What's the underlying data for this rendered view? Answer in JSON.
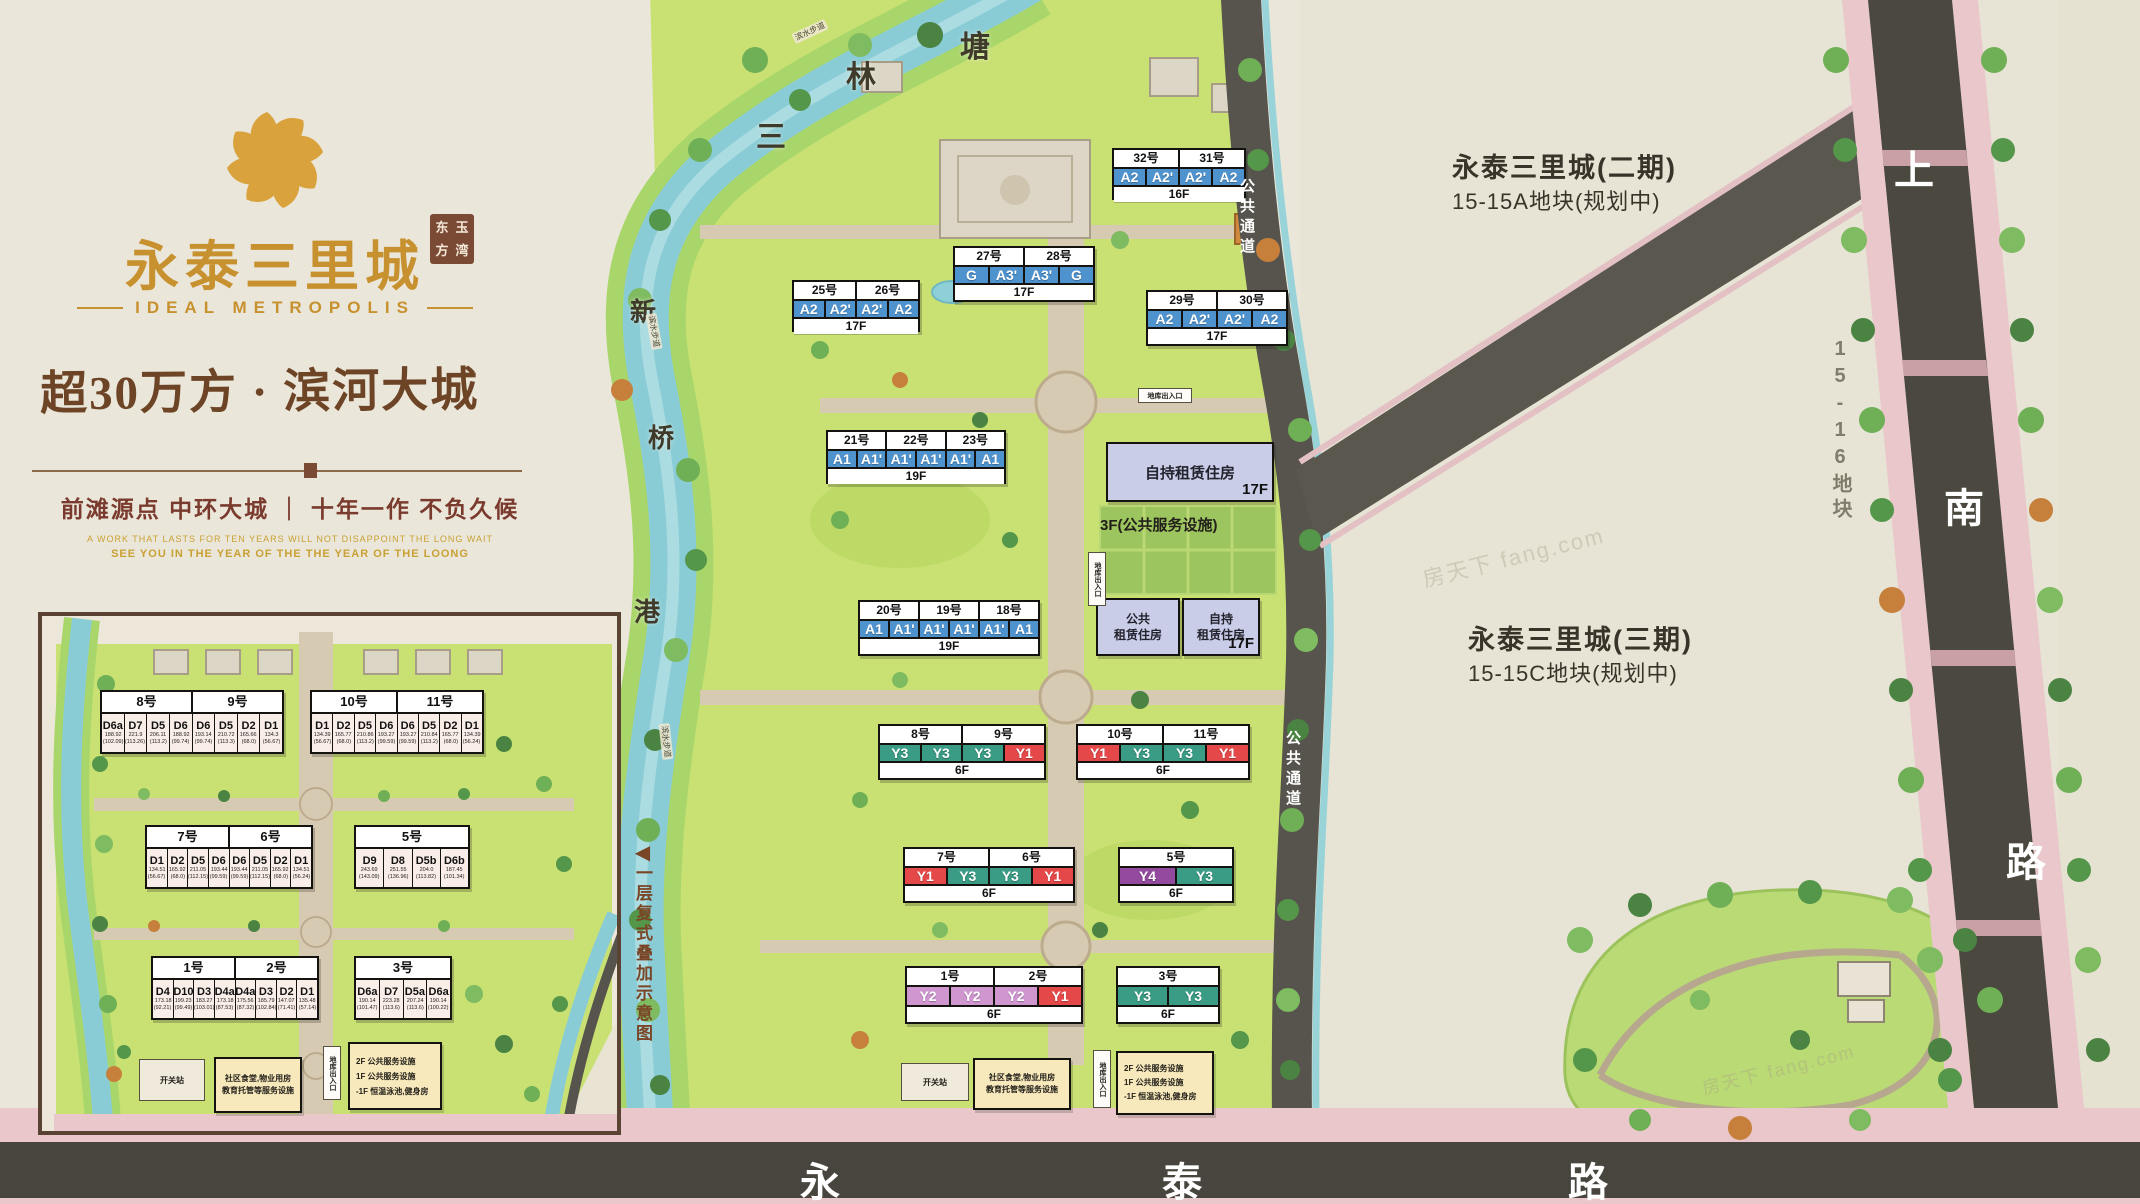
{
  "branding": {
    "title": "永泰三里城",
    "seal_chars": [
      "东",
      "玉",
      "方",
      "湾"
    ],
    "subtitle": "IDEAL METROPOLIS",
    "headline": "超30万方 · 滨河大城",
    "slogan": "前滩源点 中环大城 ｜ 十年一作 不负久候",
    "tagline_en_1": "A WORK THAT LASTS FOR TEN YEARS WILL NOT DISAPPOINT THE LONG WAIT",
    "tagline_en_2": "SEE YOU IN THE YEAR OF THE THE YEAR OF THE LOONG"
  },
  "colors": {
    "A1": "#4f93ce",
    "A1'": "#4f93ce",
    "A2": "#4f93ce",
    "A2'": "#4f93ce",
    "A3'": "#4f93ce",
    "G": "#4f93ce",
    "Y1": "#e54848",
    "Y2": "#cf96cf",
    "Y3": "#3a9c84",
    "Y4": "#93499e",
    "D": "#f9ede7"
  },
  "main_plan": {
    "buildings": [
      {
        "labels": [
          "32号",
          "31号"
        ],
        "units": [
          "A2",
          "A2'",
          "A2'",
          "A2"
        ],
        "floor": "16F",
        "x": 1112,
        "y": 148,
        "w": 134,
        "h": 52
      },
      {
        "labels": [
          "27号",
          "28号"
        ],
        "units": [
          "G",
          "A3'",
          "A3'",
          "G"
        ],
        "floor": "17F",
        "x": 953,
        "y": 246,
        "w": 142,
        "h": 56
      },
      {
        "labels": [
          "29号",
          "30号"
        ],
        "units": [
          "A2",
          "A2'",
          "A2'",
          "A2"
        ],
        "floor": "17F",
        "x": 1146,
        "y": 290,
        "w": 142,
        "h": 56
      },
      {
        "labels": [
          "25号",
          "26号"
        ],
        "units": [
          "A2",
          "A2'",
          "A2'",
          "A2"
        ],
        "floor": "17F",
        "x": 792,
        "y": 280,
        "w": 128,
        "h": 52
      },
      {
        "labels": [
          "21号",
          "22号",
          "23号"
        ],
        "units": [
          "A1",
          "A1'",
          "A1'",
          "A1'",
          "A1'",
          "A1"
        ],
        "floor": "19F",
        "x": 826,
        "y": 430,
        "w": 180,
        "h": 54
      },
      {
        "labels": [
          "20号",
          "19号",
          "18号"
        ],
        "units": [
          "A1",
          "A1'",
          "A1'",
          "A1'",
          "A1'",
          "A1"
        ],
        "floor": "19F",
        "x": 858,
        "y": 600,
        "w": 182,
        "h": 56
      },
      {
        "labels": [
          "8号",
          "9号"
        ],
        "units": [
          "Y3",
          "Y3",
          "Y3",
          "Y1"
        ],
        "floor": "6F",
        "x": 878,
        "y": 724,
        "w": 168,
        "h": 56
      },
      {
        "labels": [
          "10号",
          "11号"
        ],
        "units": [
          "Y1",
          "Y3",
          "Y3",
          "Y1"
        ],
        "floor": "6F",
        "x": 1076,
        "y": 724,
        "w": 174,
        "h": 56
      },
      {
        "labels": [
          "7号",
          "6号"
        ],
        "units": [
          "Y1",
          "Y3",
          "Y3",
          "Y1"
        ],
        "floor": "6F",
        "x": 903,
        "y": 847,
        "w": 172,
        "h": 56
      },
      {
        "labels": [
          "5号"
        ],
        "units": [
          "Y4",
          "Y3"
        ],
        "floor": "6F",
        "x": 1118,
        "y": 847,
        "w": 116,
        "h": 56
      },
      {
        "labels": [
          "1号",
          "2号"
        ],
        "units": [
          "Y2",
          "Y2",
          "Y2",
          "Y1"
        ],
        "floor": "6F",
        "x": 905,
        "y": 966,
        "w": 178,
        "h": 58
      },
      {
        "labels": [
          "3号"
        ],
        "units": [
          "Y3",
          "Y3"
        ],
        "floor": "6F",
        "x": 1116,
        "y": 966,
        "w": 104,
        "h": 58
      }
    ],
    "rental_big_label": "自持租赁住房",
    "rental_big_floor": "17F",
    "rental_note": "3F(公共服务设施)",
    "rental_public_l1": "公共",
    "rental_public_l2": "租赁住房",
    "rental_self_l1": "自持",
    "rental_self_l2": "租赁住房",
    "rental_self_floor": "17F"
  },
  "inset": {
    "note_arrow": "◀",
    "note": "一层复式叠加示意图",
    "buildings": [
      {
        "labels": [
          "8号",
          "9号"
        ],
        "x": 96,
        "y": 686,
        "w": 184,
        "h": 64,
        "units": [
          {
            "t": "D6a",
            "a": "188.92",
            "b": "(102.09)"
          },
          {
            "t": "D7",
            "a": "221.9",
            "b": "(113.26)"
          },
          {
            "t": "D5",
            "a": "206.11",
            "b": "(113.2)"
          },
          {
            "t": "D6",
            "a": "188.92",
            "b": "(99.74)"
          },
          {
            "t": "D6",
            "a": "193.14",
            "b": "(99.74)"
          },
          {
            "t": "D5",
            "a": "210.72",
            "b": "(113.3)"
          },
          {
            "t": "D2",
            "a": "165.66",
            "b": "(68.0)"
          },
          {
            "t": "D1",
            "a": "134.3",
            "b": "(56.67)"
          }
        ]
      },
      {
        "labels": [
          "10号",
          "11号"
        ],
        "x": 306,
        "y": 686,
        "w": 174,
        "h": 64,
        "units": [
          {
            "t": "D1",
            "a": "134.39",
            "b": "(56.67)"
          },
          {
            "t": "D2",
            "a": "165.77",
            "b": "(68.0)"
          },
          {
            "t": "D5",
            "a": "210.86",
            "b": "(113.2)"
          },
          {
            "t": "D6",
            "a": "193.27",
            "b": "(99.59)"
          },
          {
            "t": "D6",
            "a": "193.27",
            "b": "(99.59)"
          },
          {
            "t": "D5",
            "a": "210.84",
            "b": "(113.2)"
          },
          {
            "t": "D2",
            "a": "165.77",
            "b": "(68.0)"
          },
          {
            "t": "D1",
            "a": "134.39",
            "b": "(56.24)"
          }
        ]
      },
      {
        "labels": [
          "7号",
          "6号"
        ],
        "x": 141,
        "y": 821,
        "w": 168,
        "h": 64,
        "units": [
          {
            "t": "D1",
            "a": "134.51",
            "b": "(56.67)"
          },
          {
            "t": "D2",
            "a": "165.92",
            "b": "(68.0)"
          },
          {
            "t": "D5",
            "a": "211.05",
            "b": "(112.15)"
          },
          {
            "t": "D6",
            "a": "193.44",
            "b": "(99.59)"
          },
          {
            "t": "D6",
            "a": "193.44",
            "b": "(99.59)"
          },
          {
            "t": "D5",
            "a": "211.05",
            "b": "(112.15)"
          },
          {
            "t": "D2",
            "a": "165.92",
            "b": "(68.0)"
          },
          {
            "t": "D1",
            "a": "134.51",
            "b": "(56.24)"
          }
        ]
      },
      {
        "labels": [
          "5号"
        ],
        "x": 350,
        "y": 821,
        "w": 116,
        "h": 64,
        "units": [
          {
            "t": "D9",
            "a": "243.69",
            "b": "(143.09)"
          },
          {
            "t": "D8",
            "a": "251.55",
            "b": "(136.96)"
          },
          {
            "t": "D5b",
            "a": "204.0",
            "b": "(113.82)"
          },
          {
            "t": "D6b",
            "a": "187.45",
            "b": "(101.34)"
          }
        ]
      },
      {
        "labels": [
          "1号",
          "2号"
        ],
        "x": 147,
        "y": 952,
        "w": 168,
        "h": 64,
        "units": [
          {
            "t": "D4",
            "a": "173.18",
            "b": "(92.21)"
          },
          {
            "t": "D10",
            "a": "199.23",
            "b": "(99.49)"
          },
          {
            "t": "D3",
            "a": "183.27",
            "b": "(103.01)"
          },
          {
            "t": "D4a",
            "a": "173.18",
            "b": "(87.53)"
          },
          {
            "t": "D4a",
            "a": "175.56",
            "b": "(87.32)"
          },
          {
            "t": "D3",
            "a": "185.79",
            "b": "(102.84)"
          },
          {
            "t": "D2",
            "a": "147.07",
            "b": "(71.41)"
          },
          {
            "t": "D1",
            "a": "135.48",
            "b": "(57.14)"
          }
        ]
      },
      {
        "labels": [
          "3号"
        ],
        "x": 350,
        "y": 952,
        "w": 98,
        "h": 64,
        "units": [
          {
            "t": "D6a",
            "a": "190.14",
            "b": "(101.47)"
          },
          {
            "t": "D7",
            "a": "223.28",
            "b": "(113.6)"
          },
          {
            "t": "D5a",
            "a": "207.24",
            "b": "(113.6)"
          },
          {
            "t": "D6a",
            "a": "190.14",
            "b": "(100.22)"
          }
        ]
      }
    ]
  },
  "facilities": {
    "switch_station": "开关站",
    "community_l1": "社区食堂,物业用房",
    "community_l2": "教育托管等服务设施",
    "garage": "地库出入口",
    "service_lines": [
      "2F 公共服务设施",
      "1F 公共服务设施",
      "-1F 恒温泳池,健身房"
    ]
  },
  "context": {
    "phase2_title": "永泰三里城(二期)",
    "phase2_sub": "15-15A地块(规划中)",
    "phase3_title": "永泰三里城(三期)",
    "phase3_sub": "15-15C地块(规划中)",
    "plot_right": "15-16地块",
    "road_right": [
      "上",
      "南",
      "路"
    ],
    "road_bottom": [
      "永",
      "泰",
      "路"
    ],
    "river_top": [
      "三",
      "林",
      "塘"
    ],
    "river_left": [
      "新",
      "桥",
      "港"
    ],
    "walkway_label": "滨水步道",
    "passage_label": "公共通道",
    "watermark": "房天下 fang.com"
  }
}
